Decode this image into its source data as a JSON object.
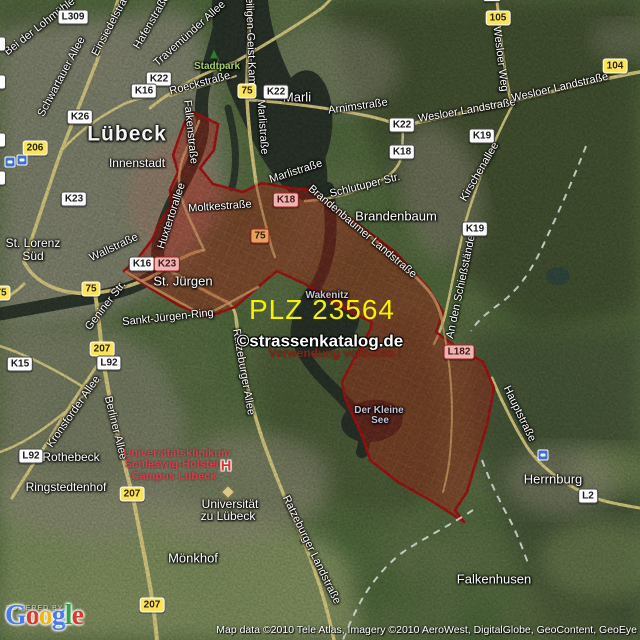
{
  "zone": {
    "plz_text": "PLZ 23564"
  },
  "watermark": {
    "line1": "©strassenkatalog.de",
    "line2": "Verwendung verboten !"
  },
  "attribution": "Map data ©2010 Tele Atlas, Imagery ©2010 AeroWest, DigitalGlobe, GeoContent, GeoEye",
  "logo": {
    "powered_by": "POWERED BY",
    "letters": [
      {
        "ch": "G",
        "color": "#4a7af0"
      },
      {
        "ch": "o",
        "color": "#d93b2b"
      },
      {
        "ch": "o",
        "color": "#f2b50f"
      },
      {
        "ch": "g",
        "color": "#4a7af0"
      },
      {
        "ch": "l",
        "color": "#34a04a"
      },
      {
        "ch": "e",
        "color": "#d93b2b"
      }
    ]
  },
  "places": {
    "luebeck": "Lübeck",
    "innenstadt": "Innenstadt",
    "marli": "Marli",
    "brandenbaum": "Brandenbaum",
    "st_lorenz_1": "St. Lorenz",
    "st_lorenz_2": "Süd",
    "st_juergen": "St. Jürgen",
    "wakenitz": "Wakenitz",
    "kleine_see_1": "Der Kleine",
    "kleine_see_2": "See",
    "rothebeck": "Rothebeck",
    "ringstedtenhof": "Ringstedtenhof",
    "moenkhof": "Mönkhof",
    "stadtpark": "Stadtpark",
    "herrnburg": "Herrnburg",
    "falkenhusen": "Falkenhusen",
    "uni_1": "Universität",
    "uni_2": "zu Lübeck",
    "klinikum_1": "Universitätsklinikum",
    "klinikum_2": "Schleswig-Holstein",
    "klinikum_3": "Campus Lübeck"
  },
  "streets": {
    "bei_der_lohmuehle": "Bei der Lohmühle",
    "schwartauer_allee": "Schwartauer Allee",
    "einsiedelstrasse": "Einsiedelstraße",
    "hafenstrasse": "Hafenstraße",
    "travemuender_allee": "Travemünder Allee",
    "heiligen_geist_kamp": "Heiligen-Geist-Kamp",
    "roeckstrasse": "Roeckstraße",
    "arnimstrasse": "Arnimstraße",
    "wesloer_landstrasse_1": "Wesloer Landstraße",
    "wesloer_landstrasse_2": "Wesloer Landstraße",
    "wesloer_weg": "Wesloer Weg",
    "kirschenallee": "Kirschenallee",
    "an_den_schiessstaenden": "An den Schießständen",
    "schlutuper_str": "Schlutuper Str.",
    "marlistrasse_1": "Marlistraße",
    "marlistrasse_2": "Marlistraße",
    "moltkestrasse": "Moltkestraße",
    "brandenbaumer_landstrasse": "Brandenbaumer Landstraße",
    "falkenstrasse": "Falkenstraße",
    "huxtertorallee": "Huxtertorallee",
    "wallstrasse": "Wallstraße",
    "geniner_str": "Geniner Str.",
    "sankt_juergen_ring": "Sankt-Jürgen-Ring",
    "kronsforder_allee": "Kronsforder Allee",
    "berliner_allee": "Berliner Allee",
    "ratzeburger_allee": "Ratzeburger Allee",
    "ratzeburger_landstrasse": "Ratzeburger Landstraße",
    "hauptstrasse": "Hauptstraße"
  },
  "badges": [
    {
      "text": "L309"
    },
    {
      "text": "K22"
    },
    {
      "text": "K16"
    },
    {
      "text": "K26"
    },
    {
      "text": "206"
    },
    {
      "text": "K23"
    },
    {
      "text": "75"
    },
    {
      "text": "K22"
    },
    {
      "text": "K22"
    },
    {
      "text": "K18"
    },
    {
      "text": "105"
    },
    {
      "text": "104"
    },
    {
      "text": "K19"
    },
    {
      "text": "K19"
    },
    {
      "text": "K18"
    },
    {
      "text": "75"
    },
    {
      "text": "K16"
    },
    {
      "text": "K23"
    },
    {
      "text": "75"
    },
    {
      "text": "207"
    },
    {
      "text": "K15"
    },
    {
      "text": "L92"
    },
    {
      "text": "L92"
    },
    {
      "text": "207"
    },
    {
      "text": "207"
    },
    {
      "text": "L182"
    },
    {
      "text": "L2"
    },
    {
      "text": ""
    },
    {
      "text": "6"
    },
    {
      "text": "5"
    },
    {
      "text": "4"
    },
    {
      "text": "4"
    },
    {
      "text": "75"
    }
  ],
  "icons": {
    "stadtpark": "tree-icon",
    "klinikum": "hospital-h-icon",
    "hospital_h": "H",
    "university": "graduation-cap-icon",
    "train_station": "train-station-icon"
  },
  "colors": {
    "plz_text": "#f6f200",
    "zone_fill": "#b91408",
    "zone_border": "#a50b0b",
    "watermark_warning": "#8a2316",
    "stadtpark_label": "#a8d06e",
    "klinikum_label": "#d2404d",
    "water_label": "#c9c2d4",
    "road_yellow": "#e6d686"
  }
}
